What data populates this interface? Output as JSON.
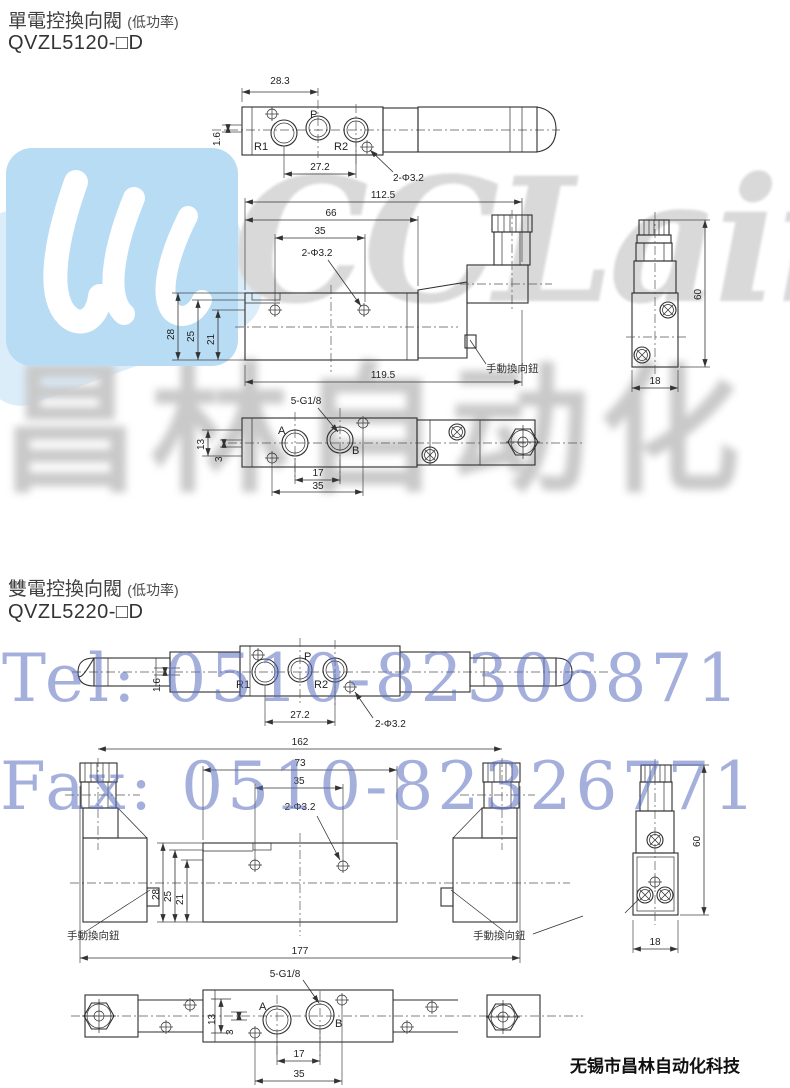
{
  "section1": {
    "title": "單電控換向閥",
    "subtitle": "(低功率)",
    "model": "QVZL5120-□D"
  },
  "section2": {
    "title": "雙電控換向閥",
    "subtitle": "(低功率)",
    "model": "QVZL5220-□D"
  },
  "watermark": {
    "brand": "CCLair",
    "brand_cn": "昌林自动化",
    "tel": "Tel: 0510-82306871",
    "fax": "Fax: 0510-82326771"
  },
  "footer": {
    "company": "无锡市昌林自动化科技"
  },
  "colors": {
    "accent_blue": "#b9dcf5",
    "watermark_gray": "#d9d9d9",
    "contact_blue": "#5a6fc0",
    "line": "#2e2e2e"
  },
  "v1": {
    "top": {
      "w283": "28.3",
      "h16": "1.6",
      "w272": "27.2",
      "hole": "2-Φ3.2",
      "port_r1": "R1",
      "port_p": "P",
      "port_r2": "R2"
    },
    "front": {
      "w1125": "112.5",
      "w66": "66",
      "w35": "35",
      "hole": "2-Φ3.2",
      "h28": "28",
      "h25": "25",
      "h21": "21",
      "w1195": "119.5",
      "manual": "手動換向鈕"
    },
    "side": {
      "h60": "60",
      "w18": "18"
    },
    "bottom": {
      "thread": "5-G1/8",
      "h13": "13",
      "h3": "3",
      "port_a": "A",
      "port_b": "B",
      "w17": "17",
      "w35": "35"
    }
  },
  "v2": {
    "top": {
      "h16": "1.6",
      "w272": "27.2",
      "hole": "2-Φ3.2",
      "port_r1": "R1",
      "port_p": "P",
      "port_r2": "R2"
    },
    "front": {
      "w162": "162",
      "w73": "73",
      "w35": "35",
      "hole": "2-Φ3.2",
      "h28": "28",
      "h25": "25",
      "h21": "21",
      "w177": "177",
      "manual_left": "手動換向鈕",
      "manual_right": "手動換向鈕"
    },
    "side": {
      "h60": "60",
      "w18": "18"
    },
    "bottom": {
      "thread": "5-G1/8",
      "h13": "13",
      "h3": "3",
      "port_a": "A",
      "port_b": "B",
      "w17": "17",
      "w35": "35"
    }
  }
}
